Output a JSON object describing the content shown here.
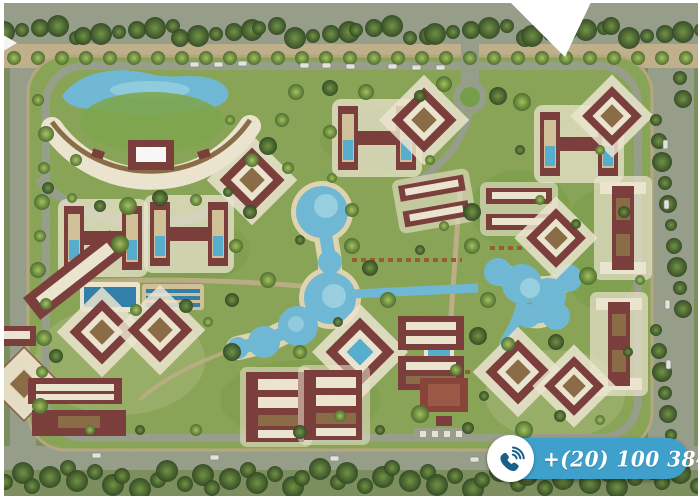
{
  "scene": {
    "type": "resort-master-plan-aerial",
    "description": "Aerial 3D master plan rendering of a gated residential resort compound: maroon-roofed apartment blocks with cream roof decks, a curved crescent hotel building with a lake at top-left, winding turquoise swimming lagoons in the center, palm landscaping, a perimeter road with parked cars, a roundabout, and a white notch cut into the top edge"
  },
  "contact": {
    "phone_display": "+(20) 100 384 7187",
    "icon": "phone-icon"
  },
  "colors": {
    "badge_blue": "#3FA0CB",
    "badge_icon_blue": "#1B5E86",
    "water_blue": "#6FBBDC",
    "water_deep": "#2E7FAE",
    "building_maroon": "#7B3A3A",
    "roof_cream": "#F2EAD6",
    "deck_brown": "#8B6B45",
    "lawn_green": "#85A154",
    "road_gray": "#98A08D",
    "sand_tan": "#C4B28D",
    "notch_white": "#FFFFFF"
  }
}
